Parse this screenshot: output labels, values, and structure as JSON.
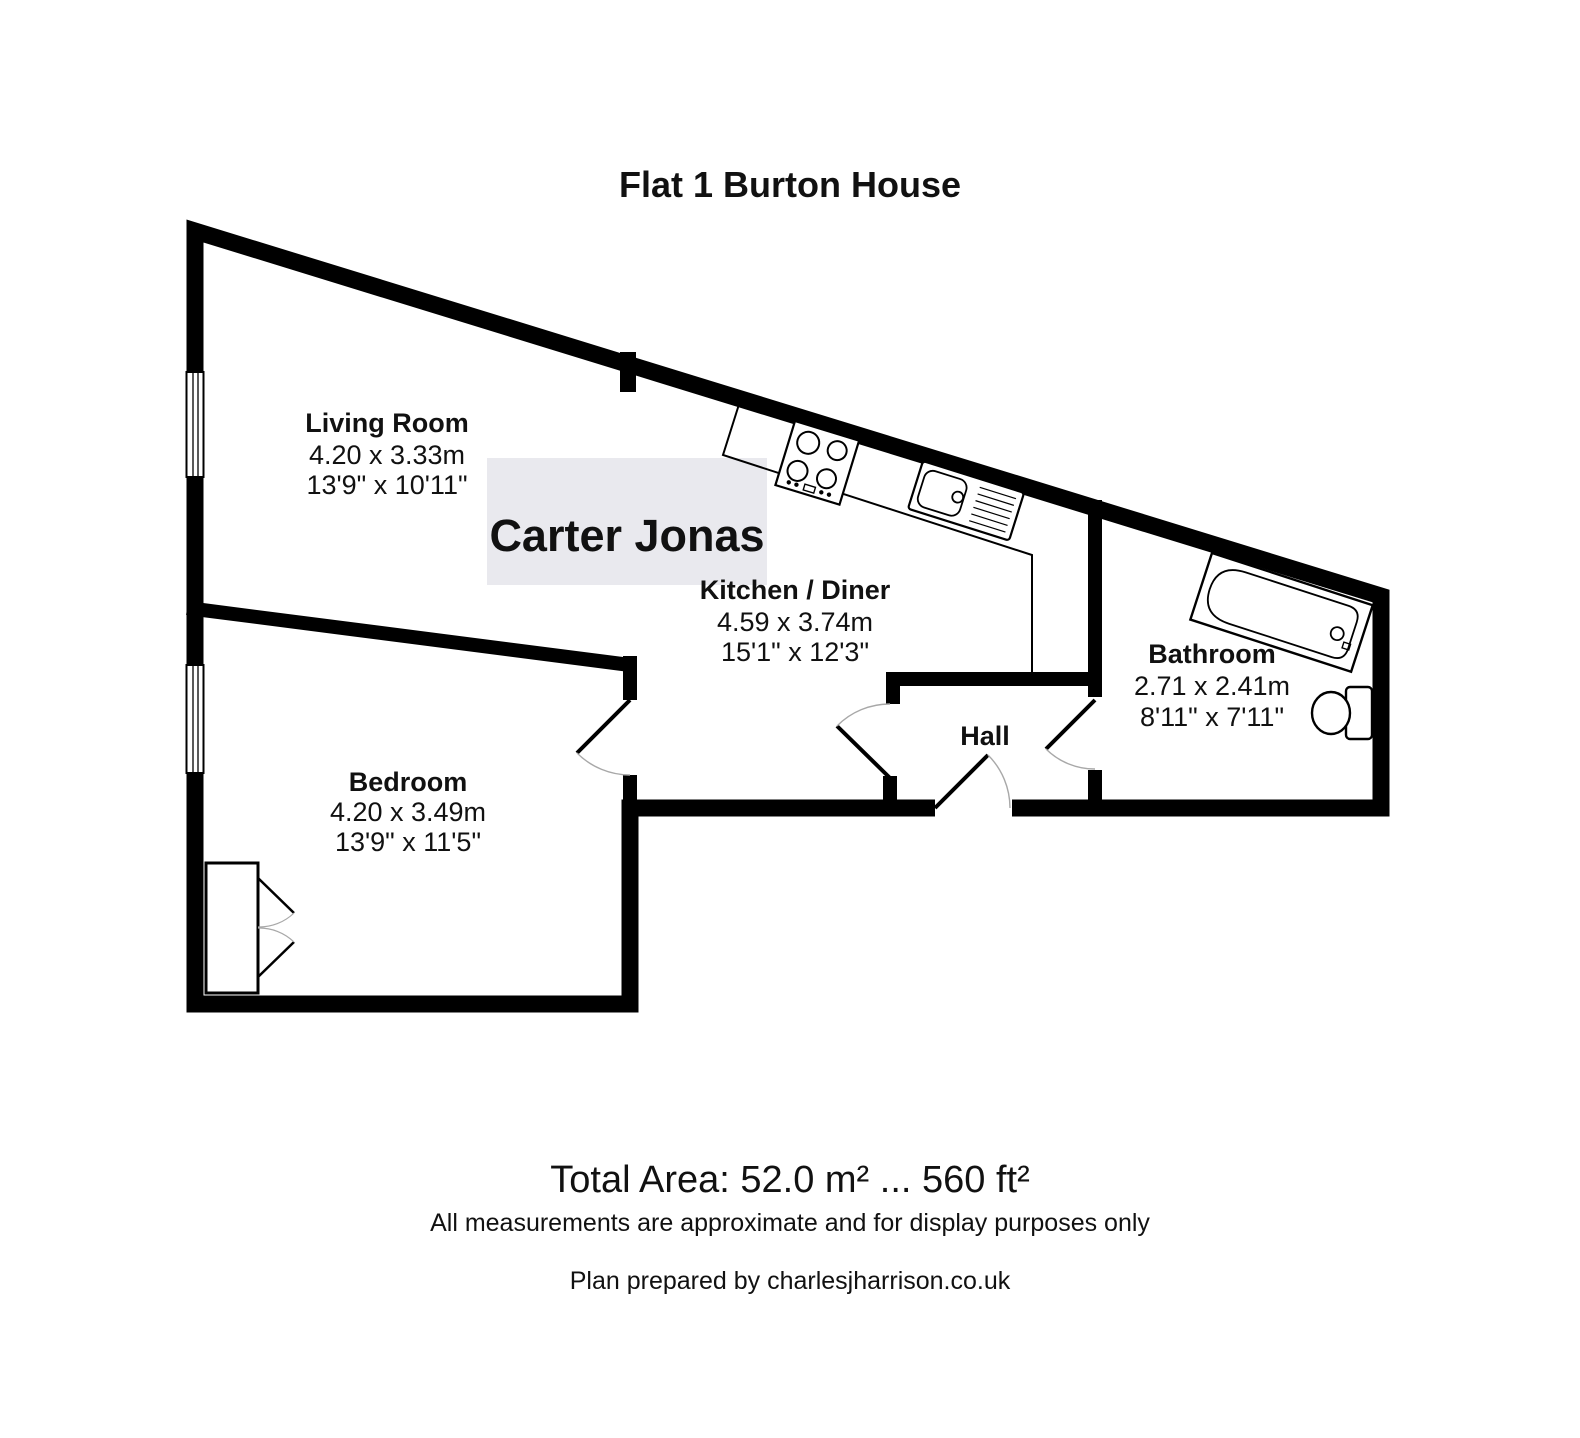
{
  "title": "Flat 1 Burton House",
  "watermark": "Carter Jonas",
  "rooms": {
    "living": {
      "name": "Living Room",
      "metric": "4.20 x 3.33m",
      "imperial": "13'9\" x 10'11\""
    },
    "kitchen": {
      "name": "Kitchen / Diner",
      "metric": "4.59 x 3.74m",
      "imperial": "15'1\" x 12'3\""
    },
    "bedroom": {
      "name": "Bedroom",
      "metric": "4.20 x 3.49m",
      "imperial": "13'9\" x 11'5\""
    },
    "bathroom": {
      "name": "Bathroom",
      "metric": "2.71 x 2.41m",
      "imperial": "8'11\" x 7'11\""
    },
    "hall": {
      "name": "Hall"
    }
  },
  "footer": {
    "total_area": "Total Area: 52.0 m² ... 560 ft²",
    "disclaimer": "All measurements are approximate and for display purposes only",
    "credit": "Plan prepared by charlesjharrison.co.uk"
  },
  "colors": {
    "wall": "#000000",
    "door_arc": "#a8a8a8",
    "watermark_bg": "#e9e9ee",
    "watermark_text": "#fdfdfe"
  }
}
